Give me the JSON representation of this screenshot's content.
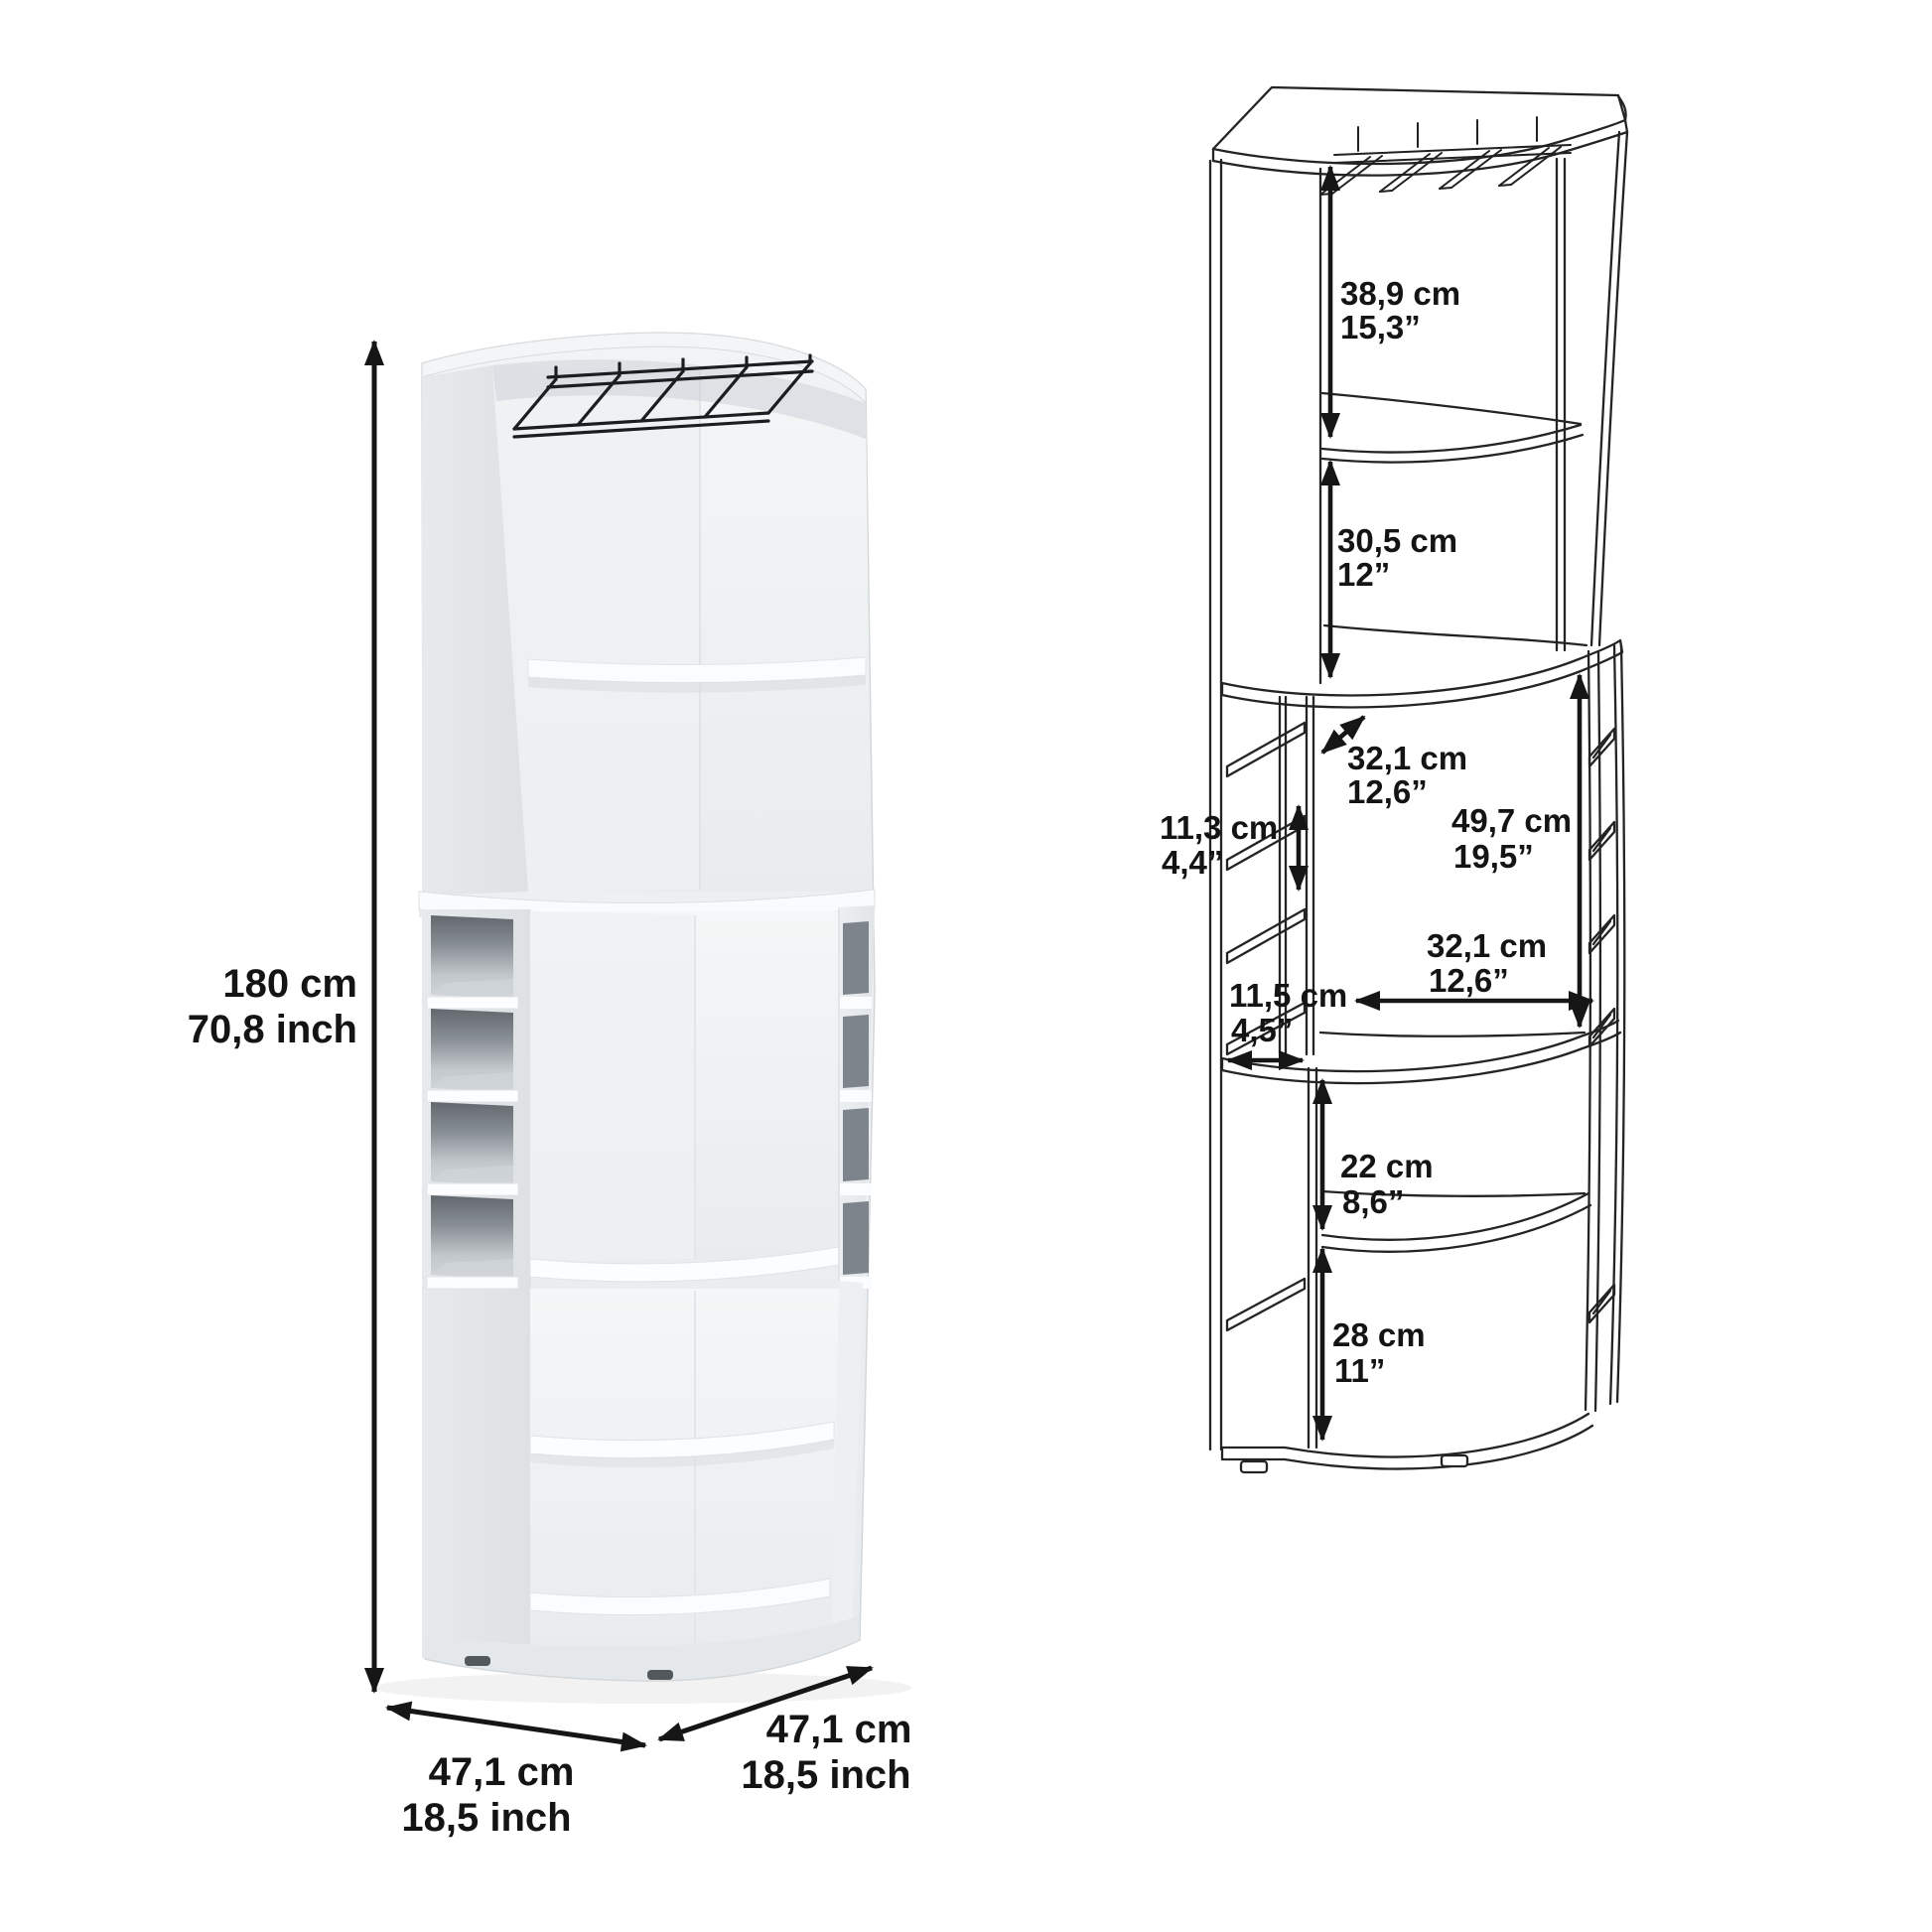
{
  "sheet": {
    "background": "#ffffff",
    "description": "Corner bar cabinet dimension sheet, rendered view left, line diagram right"
  },
  "render_view": {
    "overall_height": {
      "cm": "180 cm",
      "inch": "70,8 inch"
    },
    "left_depth": {
      "cm": "47,1 cm",
      "inch": "18,5 inch"
    },
    "right_depth": {
      "cm": "47,1 cm",
      "inch": "18,5 inch"
    }
  },
  "diagram_view": {
    "top_opening_height": {
      "cm": "38,9 cm",
      "inch": "15,3”"
    },
    "second_opening_height": {
      "cm": "30,5 cm",
      "inch": "12”"
    },
    "middle_depth": {
      "cm": "32,1 cm",
      "inch": "12,6”"
    },
    "side_cubby_height": {
      "cm": "11,3 cm",
      "inch": "4,4”"
    },
    "middle_opening_height": {
      "cm": "49,7 cm",
      "inch": "19,5”"
    },
    "middle_width": {
      "cm": "32,1 cm",
      "inch": "12,6”"
    },
    "side_cubby_width": {
      "cm": "11,5 cm",
      "inch": "4,5”"
    },
    "lower_opening_height": {
      "cm": "22 cm",
      "inch": "8,6”"
    },
    "bottom_opening_height": {
      "cm": "28 cm",
      "inch": "11”"
    }
  },
  "colors": {
    "line": "#242424",
    "arrow": "#161616",
    "text": "#141414",
    "render_body": "#eef1f3",
    "cubby_dark": "#7d848b"
  }
}
